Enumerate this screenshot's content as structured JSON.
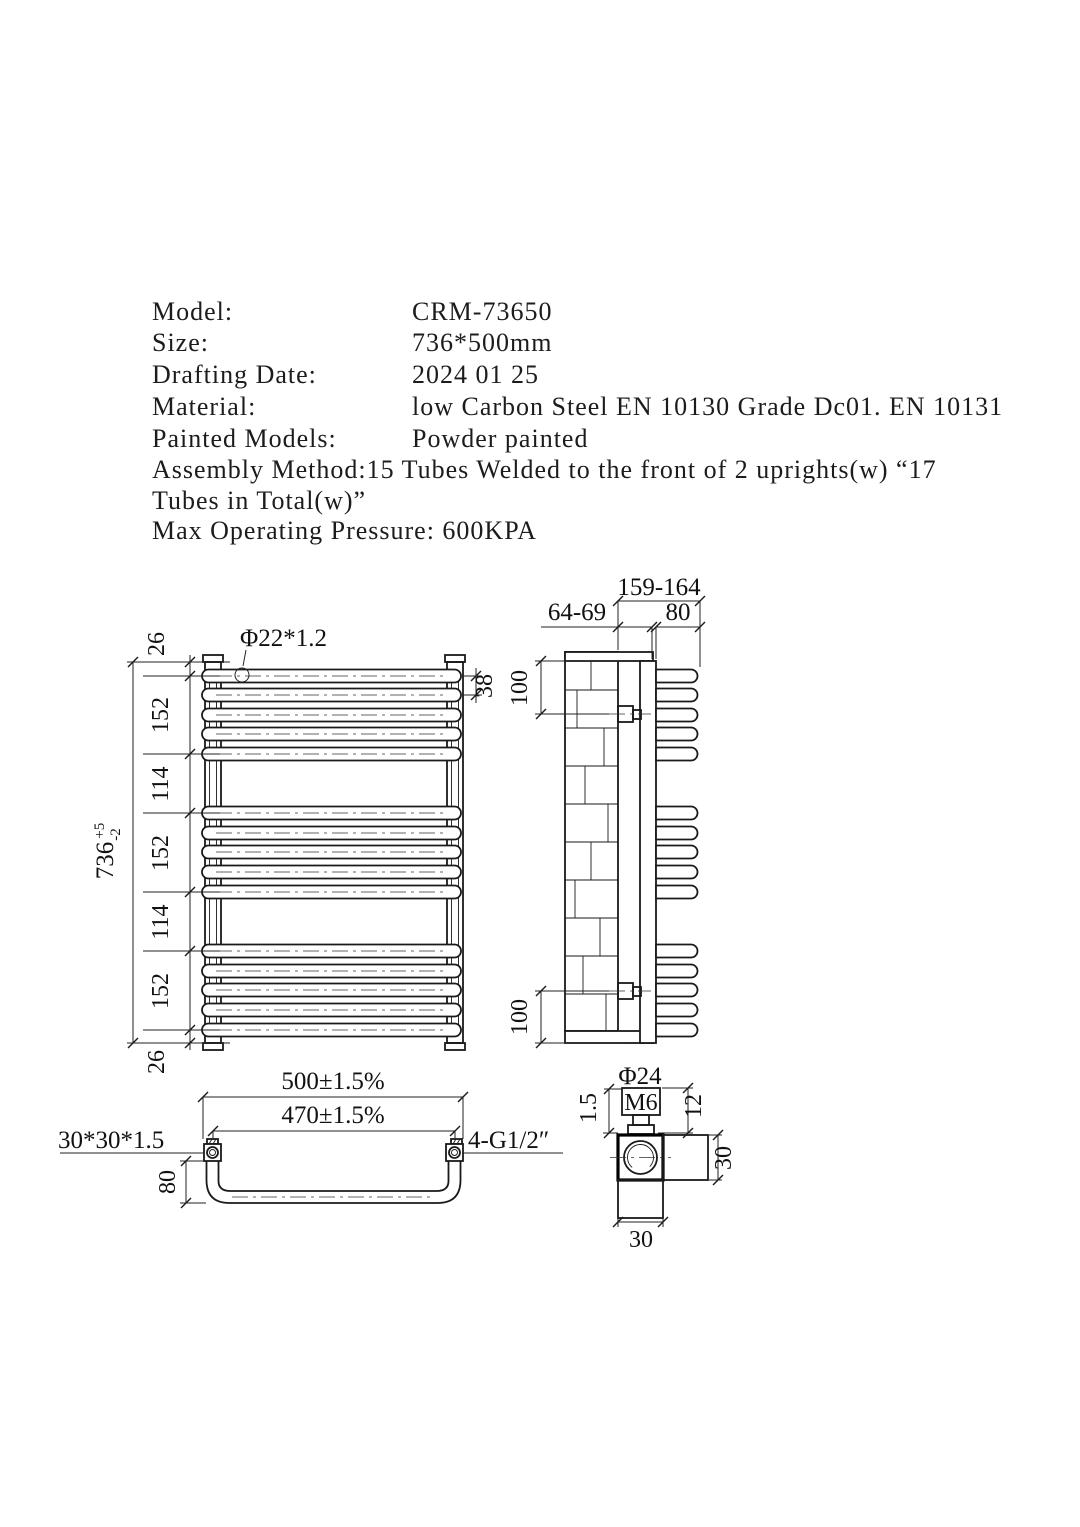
{
  "title_block": {
    "rows": [
      {
        "label": "Model:",
        "value": "CRM-73650"
      },
      {
        "label": "Size:",
        "value": "736*500mm"
      },
      {
        "label": "Drafting Date:",
        "value": "2024 01 25"
      },
      {
        "label": "Material:",
        "value": "low Carbon Steel EN 10130 Grade Dc01. EN 10131"
      },
      {
        "label": "Painted Models:",
        "value": "Powder painted"
      }
    ],
    "assembly_line_1": "Assembly Method:15 Tubes Welded to the front of 2 uprights(w) “17",
    "assembly_line_2": "Tubes in Total(w)”",
    "pressure_line": "Max Operating Pressure: 600KPA"
  },
  "front_view": {
    "tube_spec": "Φ22*1.2",
    "overall_height": "736",
    "tol_plus": "+5",
    "tol_minus": "-2",
    "segments": [
      "26",
      "152",
      "114",
      "152",
      "114",
      "152",
      "26"
    ],
    "tube_pitch": "38"
  },
  "side_view": {
    "overall_depth": "159-164",
    "wall_clearance": "64-69",
    "loop_depth": "80",
    "bracket_offset_top": "100",
    "bracket_offset_bottom": "100"
  },
  "plan_view": {
    "overall_width": "500±1.5%",
    "centres_width": "470±1.5%",
    "upright_tube_spec": "30*30*1.5",
    "connections_spec": "4-G1/2″",
    "loop_depth": "80"
  },
  "detail_view": {
    "cap_diameter": "Φ24",
    "screw_thread": "M6",
    "wall_thickness": "1.5",
    "cap_depth": "12",
    "section_width": "30",
    "section_depth": "30"
  }
}
